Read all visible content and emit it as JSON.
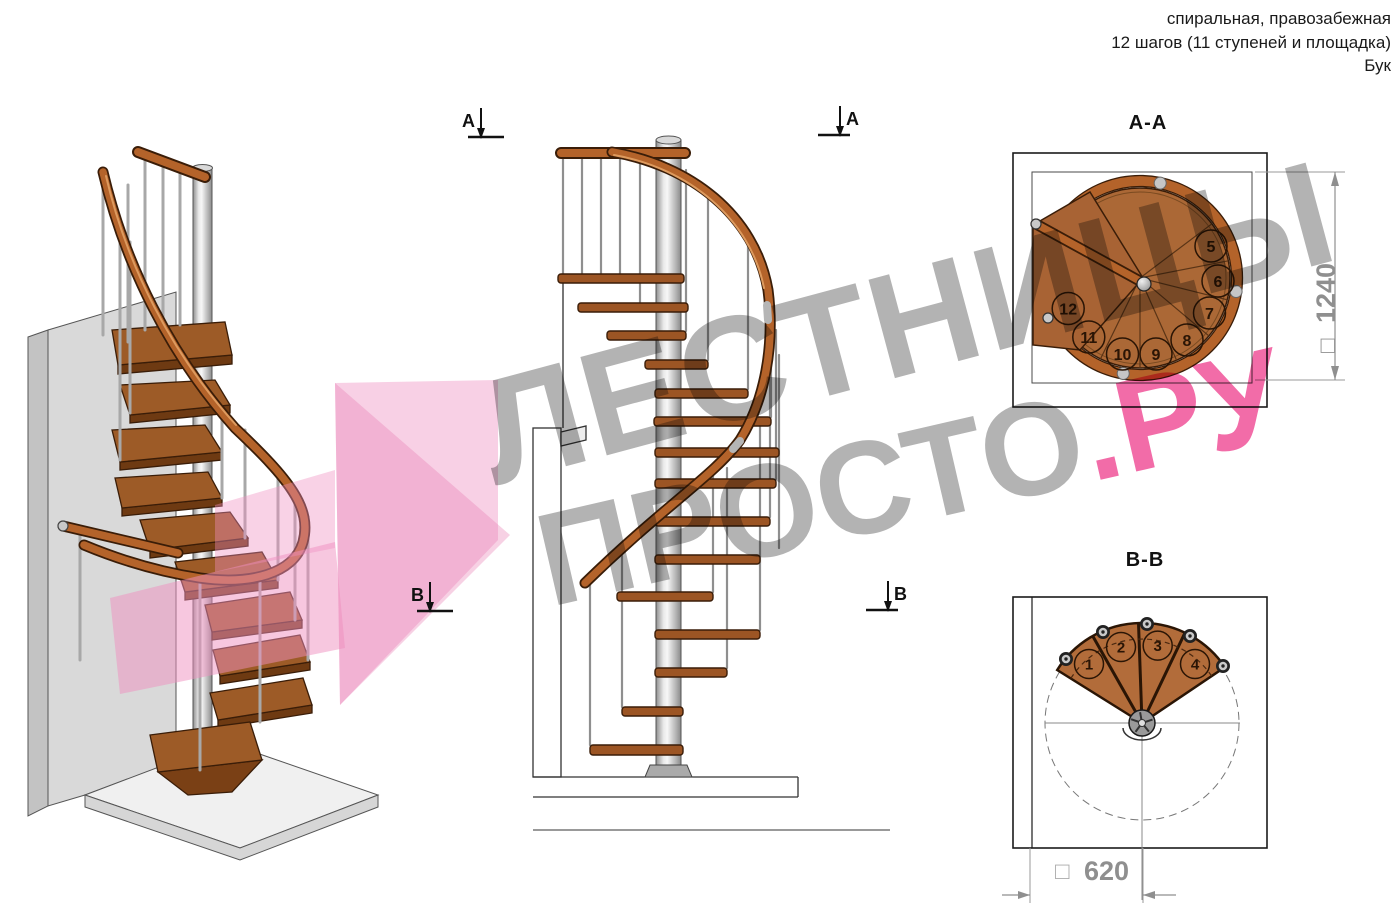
{
  "header": {
    "line1": "спиральная, правозабежная",
    "line2": "12 шагов (11 ступеней и площадка)",
    "line3": "Бук"
  },
  "section_markers": {
    "a_label": "А",
    "b_label": "В"
  },
  "views": {
    "square_symbol": "□",
    "aa": {
      "label": "А-А",
      "dimension": "1240",
      "step_numbers": [
        "5",
        "6",
        "7",
        "8",
        "9",
        "10",
        "11",
        "12"
      ]
    },
    "bb": {
      "label": "В-В",
      "dimension": "620",
      "step_numbers": [
        "1",
        "2",
        "3",
        "4"
      ]
    }
  },
  "watermark": {
    "line1": "ЛЕСТНИЦЫ",
    "line2_gray": "ПРОСТО",
    "line2_pink": ".РУ"
  },
  "colors": {
    "wood": "#a05c28",
    "wood_dark": "#6b3512",
    "handrail": "#b4632a",
    "pole_gray": "#b8b8b8",
    "dimension_gray": "#8f8f8f",
    "watermark_gray": "#b3b3b3",
    "watermark_pink": "#f26ca8",
    "arrow_pink": "#f29ec9"
  }
}
